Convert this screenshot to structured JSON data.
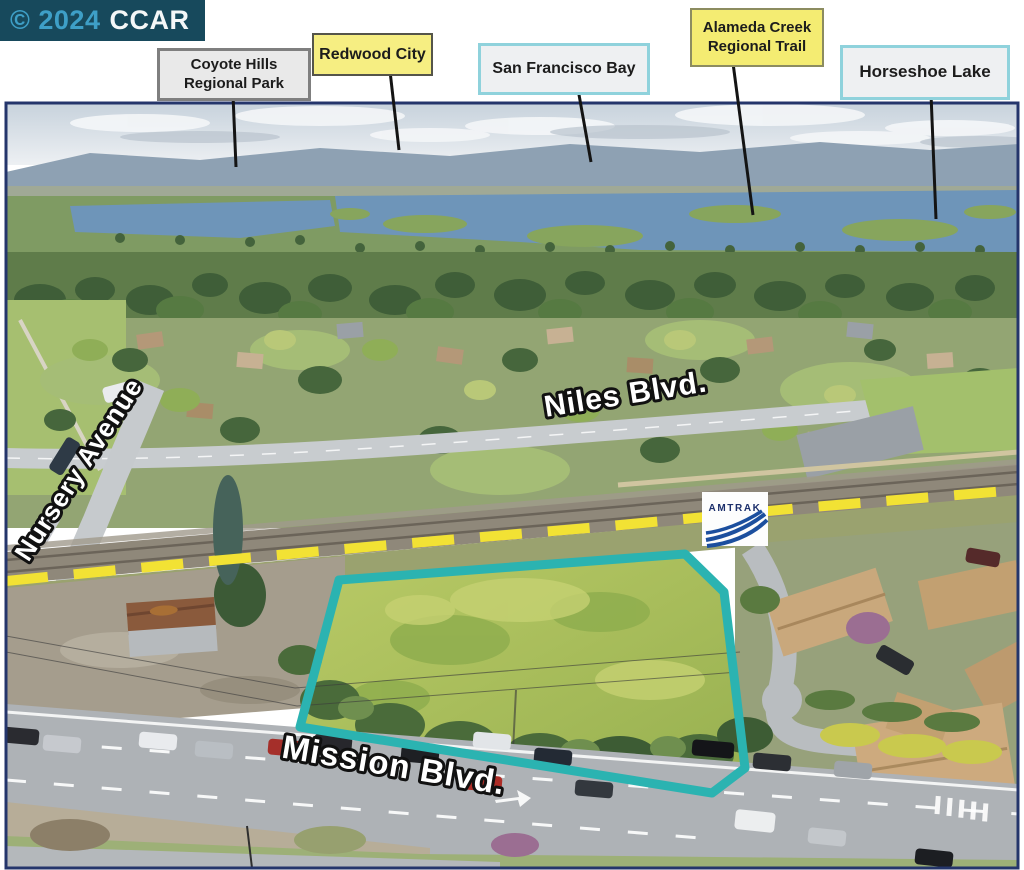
{
  "watermark": {
    "copyright": "© 2024",
    "brand": "CCAR"
  },
  "callouts": {
    "coyote_hills": {
      "label": "Coyote Hills\nRegional Park"
    },
    "redwood_city": {
      "label": "Redwood City"
    },
    "san_francisco_bay": {
      "label": "San Francisco Bay"
    },
    "alameda_creek": {
      "label": "Alameda Creek\nRegional Trail"
    },
    "horseshoe_lake": {
      "label": "Horseshoe Lake"
    }
  },
  "street_labels": {
    "nursery_avenue": "Nursery Avenue",
    "niles_blvd": "Niles Blvd.",
    "mission_blvd": "Mission Blvd."
  },
  "logos": {
    "amtrak_text": "AMTRAK"
  },
  "annotations": {
    "parcel_outline_color": "#2bb3b1",
    "railroad_marker_color": "#f2e234",
    "leader_line_color": "#141414",
    "photo_border_color": "#24356b",
    "watermark_bg": "#17495c",
    "watermark_accent": "#3e9fc7",
    "callout_yellow_bg": "#f4ec72",
    "callout_light_bg": "#eef0f2",
    "callout_teal_border": "#8fd2dc"
  }
}
